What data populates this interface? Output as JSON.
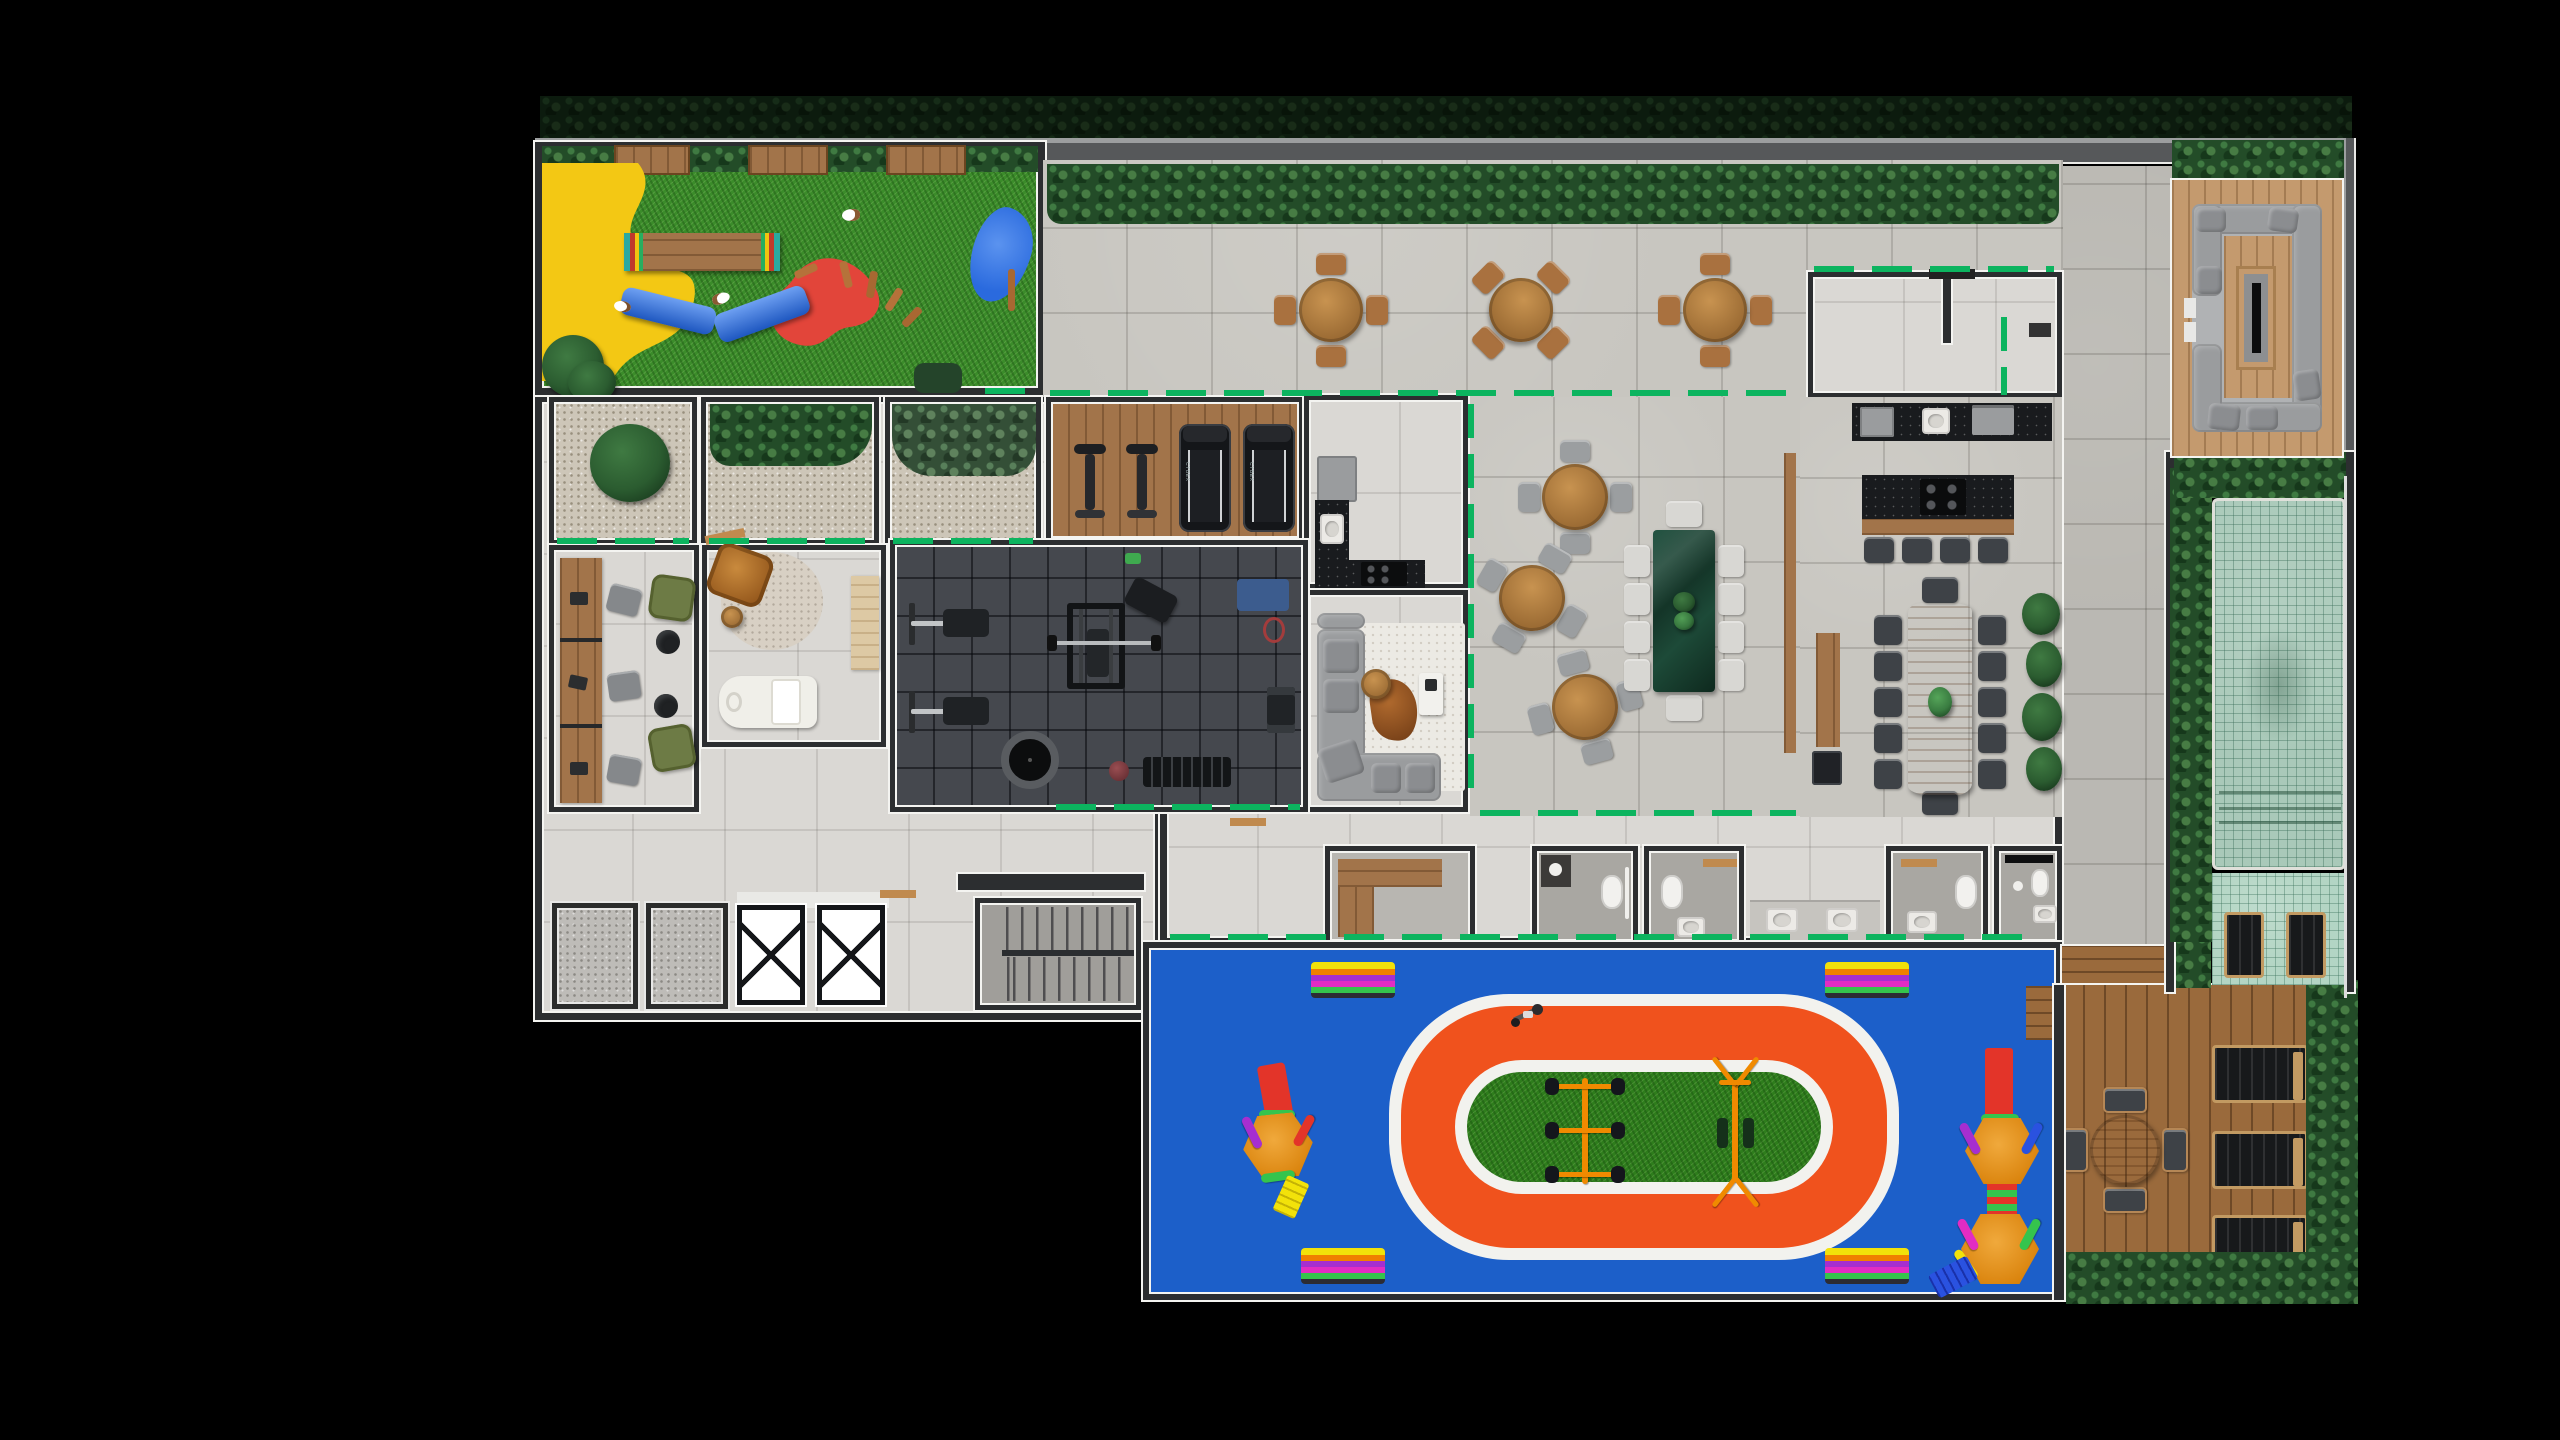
{
  "scene": {
    "type": "architectural floor plan, rendered top-down view",
    "setting": "residential building amenities floor",
    "background": "black",
    "visible_text": [
      "CYBEX"
    ]
  },
  "palette": {
    "bg": "#000000",
    "wall": "#2c2e30",
    "wallw": "#f4f4f1",
    "glass": "#0cb45f",
    "stone": "#c8c6c0",
    "tilein": "#dad8d4",
    "grass": "#3b8c2a",
    "gravel": "#cdc6b8",
    "hedged": "#234c28",
    "hedgel": "#3f7a42",
    "wood": "#a2744a",
    "deck": "#9a6a3c",
    "deckl": "#c49a6e",
    "gym": "#45484e",
    "bmarble": "#191b1e",
    "pool": "#a9c9b9",
    "petyellow": "#f3c814",
    "petred": "#e2453a",
    "petblue": "#2a6ade",
    "kidsblue": "#1c5fc9",
    "trackor": "#f0521d",
    "trackgr": "#2e7d1c",
    "bandwhite": "#f2f2ee",
    "chwood": "#a9713f",
    "chgray": "#9b9ea0",
    "chdark": "#3e4247",
    "chlight": "#d8d7d3",
    "sofa": "#9a9c9e",
    "greenchair": "#6d7b45",
    "brown": "#b5762f",
    "equipor": "#f08a00",
    "purple": "#a62ed0",
    "mag": "#e22cc3",
    "lime": "#35c44d",
    "yellowsl": "#f2e20a",
    "redsl": "#e33429",
    "bluesl": "#2a52e0"
  },
  "regions": {
    "pet_area": {
      "label": "Pet playground with agility toys",
      "dogs": 3,
      "equipment": [
        "yellow splash pad",
        "wood agility bridge",
        "red platform with stakes",
        "blue crawl tunnels",
        "blue slide",
        "dog bed"
      ]
    },
    "terrace": {
      "label": "Outdoor terrace",
      "round_tables": 3,
      "chairs_per_table": 4
    },
    "vestibule": {
      "label": "Entry vestibule"
    },
    "courtyards": {
      "label": "Planted gravel courtyards",
      "count": 3
    },
    "cardio": {
      "label": "Cardio zone",
      "exercise_bikes": 2,
      "treadmills": 2,
      "treadmill_brand": "CYBEX"
    },
    "gym": {
      "label": "Weights gym",
      "equipment": [
        "bench stations",
        "power cage",
        "incline bench",
        "trampoline",
        "medicine ball",
        "dumbbell rack",
        "mats"
      ]
    },
    "support_kitchen": {
      "label": "Support kitchen"
    },
    "tv_lounge": {
      "label": "TV lounge with sectional sofa"
    },
    "party_hall": {
      "label": "Party hall",
      "round_tables": 3,
      "marble_table_seats": 10
    },
    "gourmet": {
      "label": "Gourmet kitchen and dining",
      "bar_stools": 4,
      "dining_chairs": 12
    },
    "coworking": {
      "label": "Coworking room",
      "desk_seats": 3,
      "armchairs": 2
    },
    "massage": {
      "label": "Massage room"
    },
    "service_core": {
      "label": "Service core",
      "elevators": 2,
      "stairwells": 1,
      "technical_shafts": 2
    },
    "changing_room": {
      "label": "Changing room with L-bench"
    },
    "bathrooms": {
      "label": "Bathroom block",
      "rooms": 4,
      "shared_sinks": 2
    },
    "kids_area": {
      "label": "Kids playground with trike track",
      "benches": 4,
      "hex_climbers": 2,
      "tricycles": 1
    },
    "pool": {
      "label": "Lap pool with mosaic tiles",
      "pool_deck_loungers": 2
    },
    "solarium": {
      "label": "Solarium wood deck",
      "sun_loungers": 3,
      "table_seats": 4
    },
    "fire_lounge": {
      "label": "Sunken fire-pit lounge"
    }
  }
}
